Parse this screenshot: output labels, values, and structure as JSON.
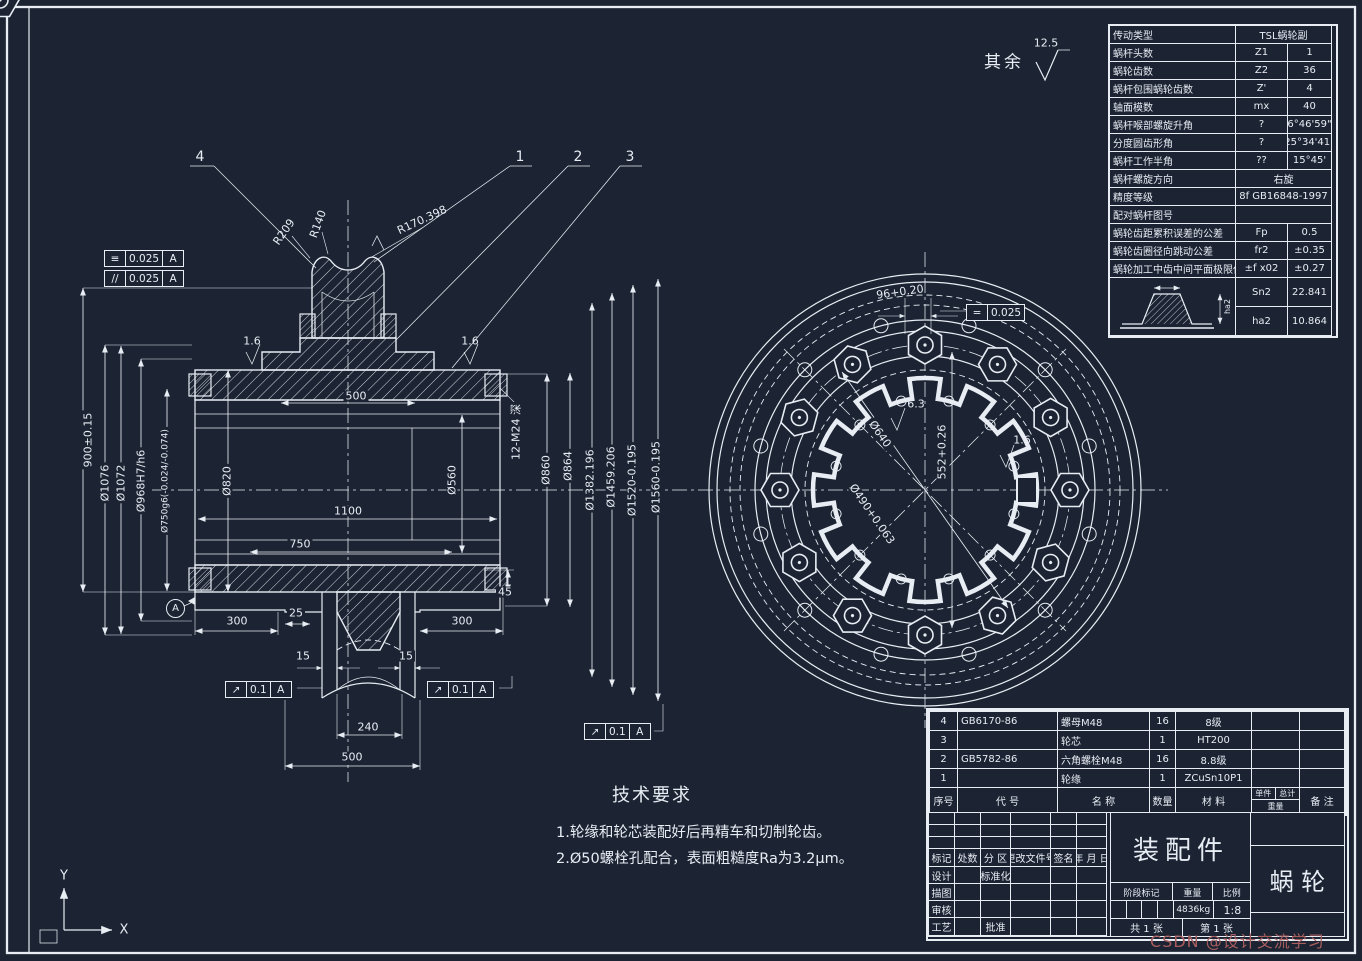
{
  "colors": {
    "bg": "#1c2433",
    "line": "#e8edf4",
    "watermark": "#a85e5e"
  },
  "roughness_note": {
    "label": "其余",
    "value": "12.5"
  },
  "balloons": [
    "4",
    "1",
    "2",
    "3"
  ],
  "front_view": {
    "fcf": [
      {
        "sym": "≡",
        "tol": "0.025",
        "datum": "A"
      },
      {
        "sym": "//",
        "tol": "0.025",
        "datum": "A"
      }
    ],
    "runout": {
      "sym": "↗",
      "tol": "0.1",
      "datum": "A"
    },
    "datum_label": "A",
    "radii": [
      "R209",
      "R140",
      "R170.398"
    ],
    "dims": {
      "axial": "900±0.15",
      "d1076": "Ø1076",
      "d1072": "Ø1072",
      "d968": "Ø968H7/h6",
      "d750": "Ø750g6(-0.024/-0.074)",
      "d820": "Ø820",
      "d560": "Ø560",
      "w500": "500",
      "w1100": "1100",
      "w750": "750",
      "w240": "240",
      "w500b": "500",
      "thread": "12-M24 深",
      "d860": "Ø860",
      "d864": "Ø864",
      "d1382": "Ø1382.196",
      "d1459": "Ø1459.206",
      "d1520": "Ø1520-0.195",
      "d1560": "Ø1560-0.195",
      "h45": "45",
      "l300a": "300",
      "l25": "25",
      "l300b": "300",
      "t15a": "15",
      "t15b": "15",
      "f16a": "1.6",
      "f16b": "1.6"
    }
  },
  "side_view": {
    "slot": "96+0.20",
    "sym_frame": {
      "sym": "=",
      "tol": "0.025"
    },
    "finish": "6.3",
    "finish_key": "1.6",
    "d640": "Ø640",
    "d490": "Ø490+0.063",
    "h552": "552+0.26"
  },
  "tech_req": {
    "title": "技术要求",
    "lines": [
      "1.轮缘和轮芯装配好后再精车和切制轮齿。",
      "2.Ø50螺栓孔配合，表面粗糙度Ra为3.2μm。"
    ]
  },
  "param_table": {
    "diagram_label": "ha2",
    "rows": [
      {
        "name": "传动类型",
        "sym": "",
        "val": "TSL蜗轮副"
      },
      {
        "name": "蜗杆头数",
        "sym": "Z1",
        "val": "1"
      },
      {
        "name": "蜗轮齿数",
        "sym": "Z2",
        "val": "36"
      },
      {
        "name": "蜗杆包围蜗轮齿数",
        "sym": "Z'",
        "val": "4"
      },
      {
        "name": "轴面模数",
        "sym": "mx",
        "val": "40"
      },
      {
        "name": "蜗杆喉部螺旋升角",
        "sym": "?",
        "val": "6°46'59\""
      },
      {
        "name": "分度圆齿形角",
        "sym": "?",
        "val": "25°34'41\""
      },
      {
        "name": "蜗杆工作半角",
        "sym": "??",
        "val": "15°45'"
      },
      {
        "name": "蜗杆螺旋方向",
        "sym": "",
        "val": "右旋"
      },
      {
        "name": "精度等级",
        "sym": "",
        "val": "8f GB16848-1997"
      },
      {
        "name": "配对蜗杆图号",
        "sym": "",
        "val": ""
      },
      {
        "name": "蜗轮齿距累积误差的公差",
        "sym": "Fp",
        "val": "0.5"
      },
      {
        "name": "蜗轮齿圈径向跳动公差",
        "sym": "fr2",
        "val": "±0.35"
      },
      {
        "name": "蜗轮加工中齿中间平面极限偏差",
        "sym": "±f x02",
        "val": "±0.27"
      },
      {
        "name": "",
        "sym": "Sn2",
        "val": "22.841"
      },
      {
        "name": "",
        "sym": "ha2",
        "val": "10.864"
      }
    ]
  },
  "bom": {
    "headers": {
      "no": "序号",
      "code": "代  号",
      "name": "名  称",
      "qty": "数量",
      "mat": "材  料",
      "unit": "单件",
      "total": "总计",
      "weight": "重量",
      "note": "备  注"
    },
    "rows": [
      {
        "no": "4",
        "code": "GB6170-86",
        "name": "螺母M48",
        "qty": "16",
        "mat": "8级",
        "note": ""
      },
      {
        "no": "3",
        "code": "",
        "name": "轮芯",
        "qty": "1",
        "mat": "HT200",
        "note": ""
      },
      {
        "no": "2",
        "code": "GB5782-86",
        "name": "六角螺栓M48",
        "qty": "16",
        "mat": "8.8级",
        "note": ""
      },
      {
        "no": "1",
        "code": "",
        "name": "轮缘",
        "qty": "1",
        "mat": "ZCuSn10P1",
        "note": ""
      }
    ]
  },
  "title_block": {
    "labels": {
      "mark": "标记",
      "count": "处数",
      "zone": "分 区",
      "doc": "更改文件号",
      "sign": "签名",
      "date": "年 月 日",
      "design": "设计",
      "std": "标准化",
      "draw": "描图",
      "check": "审核",
      "craft": "工艺",
      "approve": "批准",
      "stage": "阶段标记",
      "weight": "重量",
      "scale": "比例"
    },
    "assembly": "装配件",
    "part": "蜗  轮",
    "weight_value": "4836kg",
    "scale_value": "1:8",
    "sheet_total": "共 1 张",
    "sheet_no": "第 1 张"
  },
  "watermark": "CSDN @设计交流学习",
  "axes": {
    "x": "X",
    "y": "Y"
  }
}
